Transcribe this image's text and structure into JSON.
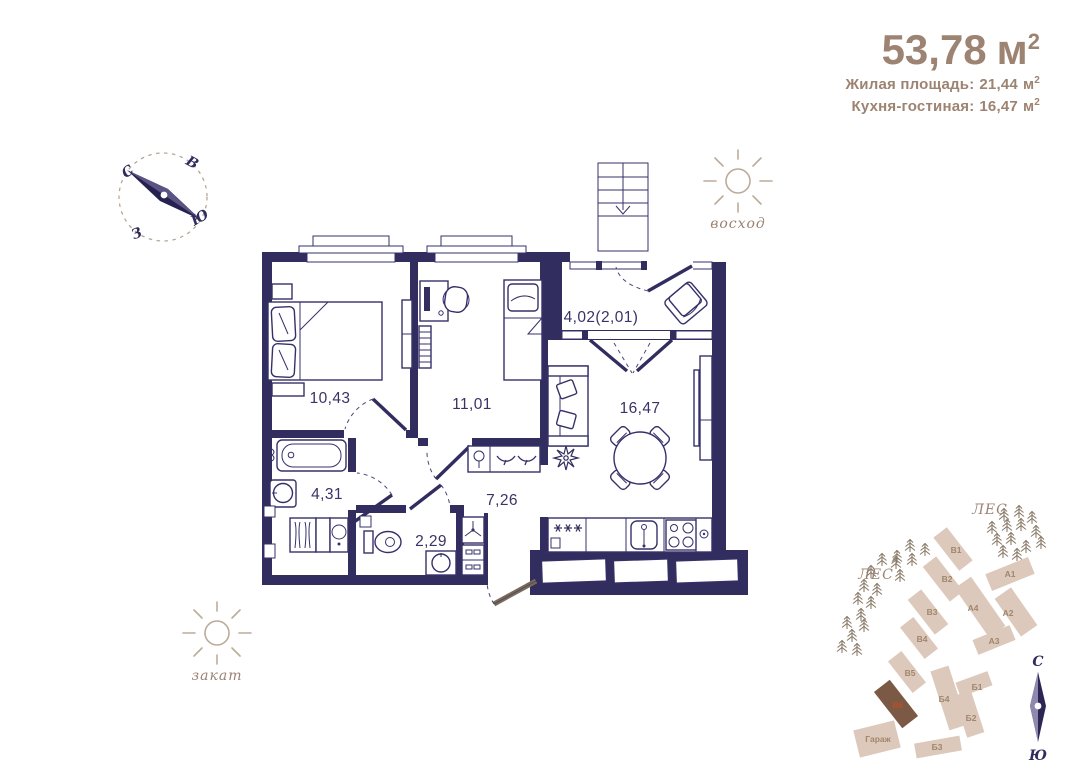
{
  "header": {
    "total": {
      "value": "53,78",
      "unit": "м",
      "sup": "2"
    },
    "living": {
      "label": "Жилая площадь:",
      "value": "21,44",
      "unit": "м",
      "sup": "2"
    },
    "kitchen": {
      "label": "Кухня-гостиная:",
      "value": "16,47",
      "unit": "м",
      "sup": "2"
    }
  },
  "compass_main": {
    "n": "С",
    "e": "В",
    "s": "Ю",
    "w": "З"
  },
  "sun": {
    "sunrise": "восход",
    "sunset": "закат"
  },
  "rooms": {
    "bedroom1": "10,43",
    "bedroom2": "11,01",
    "bathroom": "4,31",
    "wc": "2,29",
    "hall": "7,26",
    "kitchen_living": "16,47",
    "balcony": "4,02(2,01)"
  },
  "site": {
    "forest1": "ЛЕС",
    "forest2": "ЛЕС",
    "b1": "В1",
    "b2": "В2",
    "b3": "В3",
    "b4": "В4",
    "b5": "В5",
    "b6": "В6",
    "a1": "А1",
    "a2": "А2",
    "a3": "А3",
    "a4": "А4",
    "bg1": "Б1",
    "bg2": "Б2",
    "bg3": "Б3",
    "bg4": "Б4",
    "garage": "Гараж",
    "compass_n": "С",
    "compass_s": "Ю"
  },
  "colors": {
    "wall": "#322d5f",
    "accent_text": "#9d8372",
    "building": "#dcc9bb",
    "building_highlight": "#7b5945"
  }
}
